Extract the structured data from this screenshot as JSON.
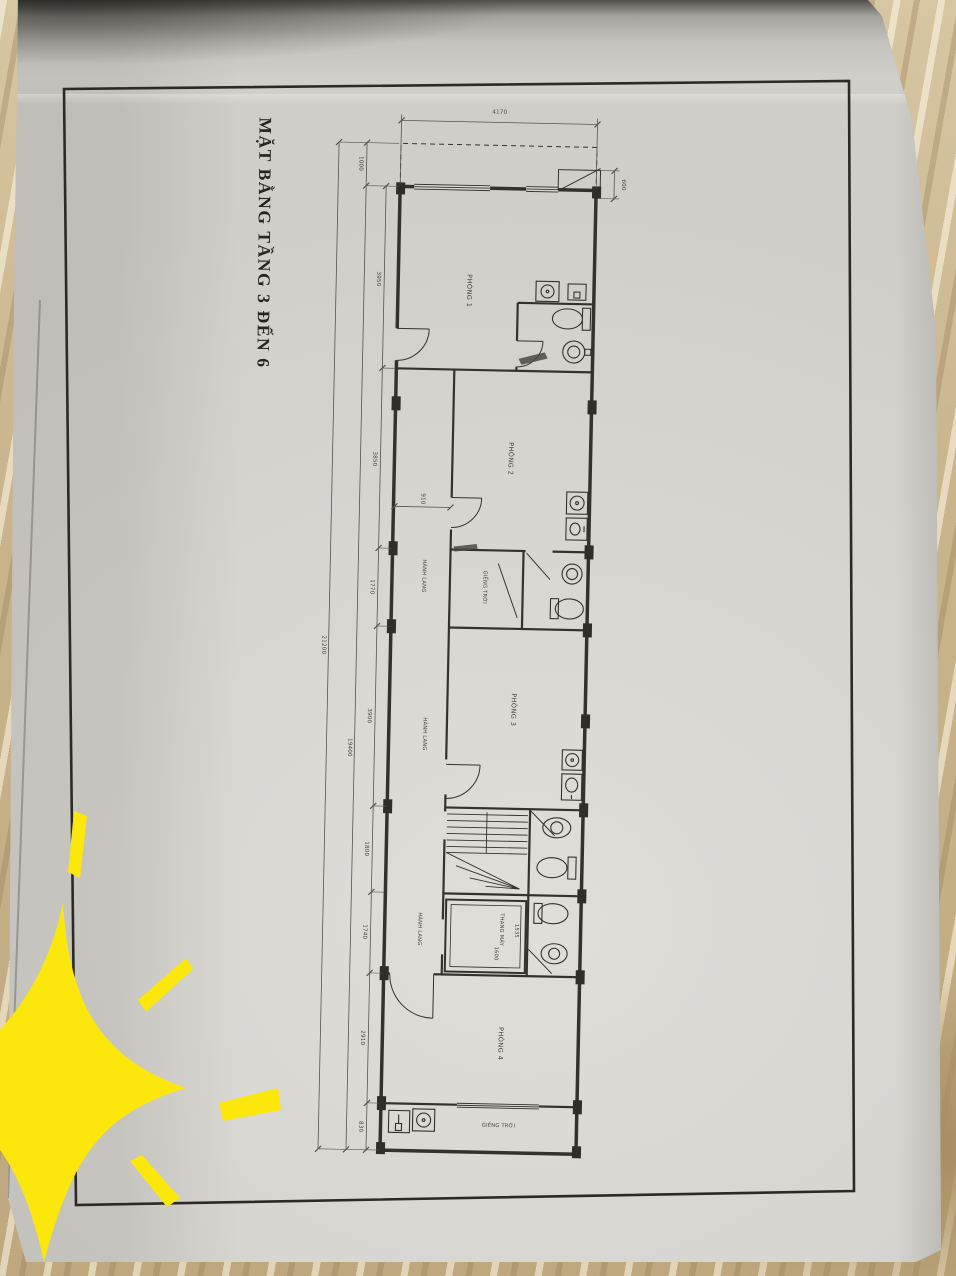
{
  "sheet": {
    "title": "MẶT BẰNG TẦNG 3 ĐẾN 6"
  },
  "rooms": {
    "room1": "PHÒNG 1",
    "room2": "PHÒNG 2",
    "room3": "PHÒNG 3",
    "room4": "PHÒNG 4",
    "corridor": "HÀNH LANG",
    "lightwell": "GIẾNG TRỜI",
    "elevator": "THANG MÁY"
  },
  "dims": {
    "top_width": "4170",
    "ledge_depth": "600",
    "balcony": "1000",
    "overall_outer": "21200",
    "overall_inner": "19400",
    "seg_room1": "3950",
    "seg_room2": "3850",
    "seg_lightwell": "1770",
    "seg_room3": "3900",
    "seg_stair": "1800",
    "seg_elevator": "1740",
    "seg_room4": "2910",
    "seg_rear": "830",
    "corridor_width": "910",
    "elevator_width": "1600",
    "elevator_depth": "1535"
  }
}
